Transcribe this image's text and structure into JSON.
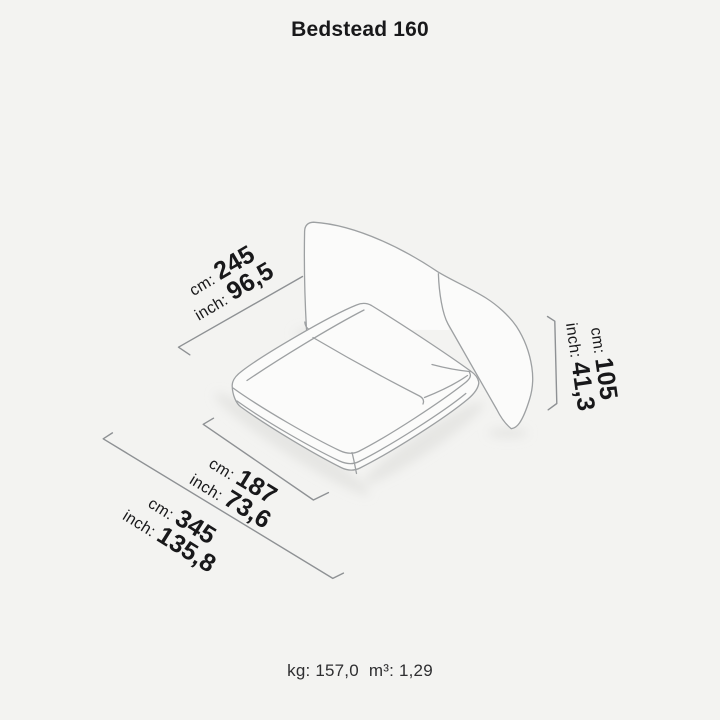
{
  "title": "Bedstead 160",
  "dimensions": {
    "width_total": {
      "cm_label": "cm:",
      "cm_value": "245",
      "inch_label": "inch:",
      "inch_value": "96,5"
    },
    "height": {
      "cm_label": "cm:",
      "cm_value": "105",
      "inch_label": "inch:",
      "inch_value": "41,3"
    },
    "width_mattress": {
      "cm_label": "cm:",
      "cm_value": "187",
      "inch_label": "inch:",
      "inch_value": "73,6"
    },
    "depth_total": {
      "cm_label": "cm:",
      "cm_value": "345",
      "inch_label": "inch:",
      "inch_value": "135,8"
    }
  },
  "footer": {
    "weight_label": "kg:",
    "weight_value": "157,0",
    "volume_label": "m³:",
    "volume_value": "1,29"
  },
  "colors": {
    "background": "#f3f3f1",
    "line": "#9da0a2",
    "dim_line": "#8e9194",
    "text": "#18181a",
    "muted_text": "#2e2e30",
    "fill": "#fbfbfa",
    "shadow": "#dededb"
  }
}
